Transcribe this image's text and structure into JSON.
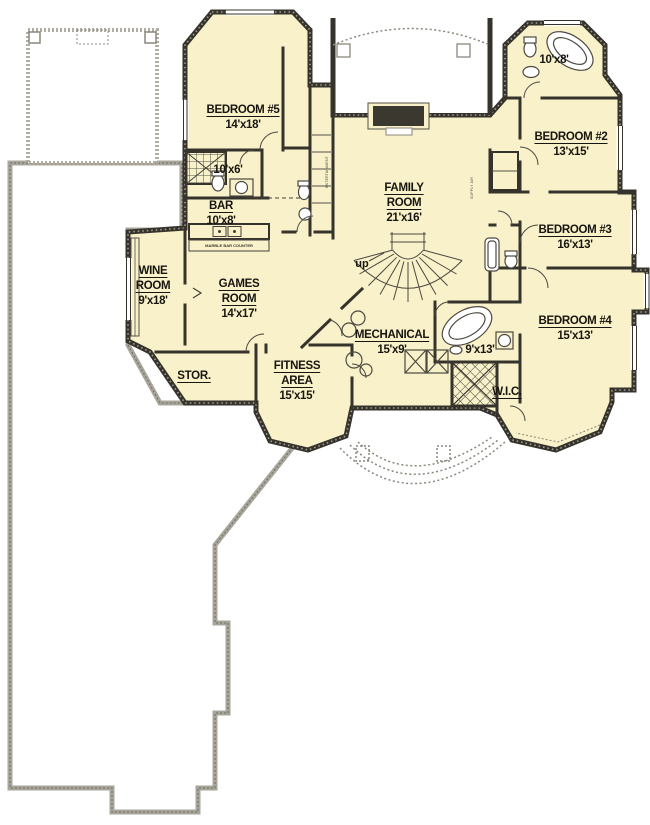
{
  "colors": {
    "floor_fill": "#f8f1c9",
    "wall": "#36332c",
    "unexcavated_wall": "#a8a59a",
    "thin_line": "#4c4942"
  },
  "rooms": [
    {
      "id": "bedroom-5",
      "lines": [
        "BEDROOM #5"
      ],
      "dims": "14'x18'"
    },
    {
      "id": "bath-bedroom-5",
      "lines": [],
      "dims": "10'x6'"
    },
    {
      "id": "bar",
      "lines": [
        "BAR"
      ],
      "dims": "10'x8'"
    },
    {
      "id": "wine-room",
      "lines": [
        "WINE",
        "ROOM"
      ],
      "dims": "9'x18'"
    },
    {
      "id": "games-room",
      "lines": [
        "GAMES",
        "ROOM"
      ],
      "dims": "14'x17'"
    },
    {
      "id": "family-room",
      "lines": [
        "FAMILY",
        "ROOM"
      ],
      "dims": "21'x16'"
    },
    {
      "id": "bath-upper-right",
      "lines": [],
      "dims": "10'x8'"
    },
    {
      "id": "bedroom-2",
      "lines": [
        "BEDROOM #2"
      ],
      "dims": "13'x15'"
    },
    {
      "id": "bedroom-3",
      "lines": [
        "BEDROOM #3"
      ],
      "dims": "16'x13'"
    },
    {
      "id": "bedroom-4",
      "lines": [
        "BEDROOM #4"
      ],
      "dims": "15'x13'"
    },
    {
      "id": "mechanical",
      "lines": [
        "MECHANICAL"
      ],
      "dims": "15'x9'"
    },
    {
      "id": "bath-9x13",
      "lines": [],
      "dims": "9'x13'"
    },
    {
      "id": "fitness-area",
      "lines": [
        "FITNESS",
        "AREA"
      ],
      "dims": "15'x15'"
    },
    {
      "id": "storage",
      "lines": [
        "STOR."
      ],
      "dims": ""
    },
    {
      "id": "walk-in-closet",
      "lines": [
        "W.I.C."
      ],
      "dims": ""
    }
  ],
  "annotations": {
    "stairs": "up",
    "bar_counter": "MARBLE BAR COUNTER",
    "closet_entertainment": "ENTERTAINMENT",
    "closet_supply": "SUPPLY AIR"
  }
}
